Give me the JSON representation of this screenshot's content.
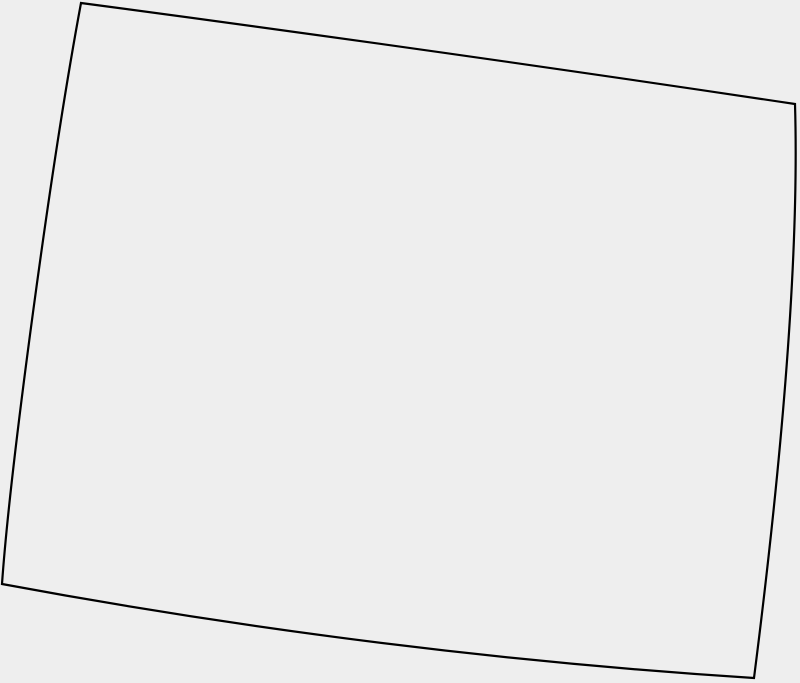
{
  "canvas": {
    "width": 800,
    "height": 683,
    "background_color": "#eeeeee"
  },
  "map": {
    "region_name": "state-boundary-outline",
    "stroke_color": "#000000",
    "stroke_width": 2.2,
    "fill_color": "#eeeeee",
    "path_segments": [
      [
        "M",
        81,
        3
      ],
      [
        "Q",
        435,
        50,
        795,
        104
      ],
      [
        "Q",
        801,
        310,
        754,
        678
      ],
      [
        "Q",
        378,
        654,
        2,
        584
      ],
      [
        "C",
        10,
        470,
        50,
        170,
        81,
        3
      ],
      [
        "Z"
      ]
    ]
  }
}
